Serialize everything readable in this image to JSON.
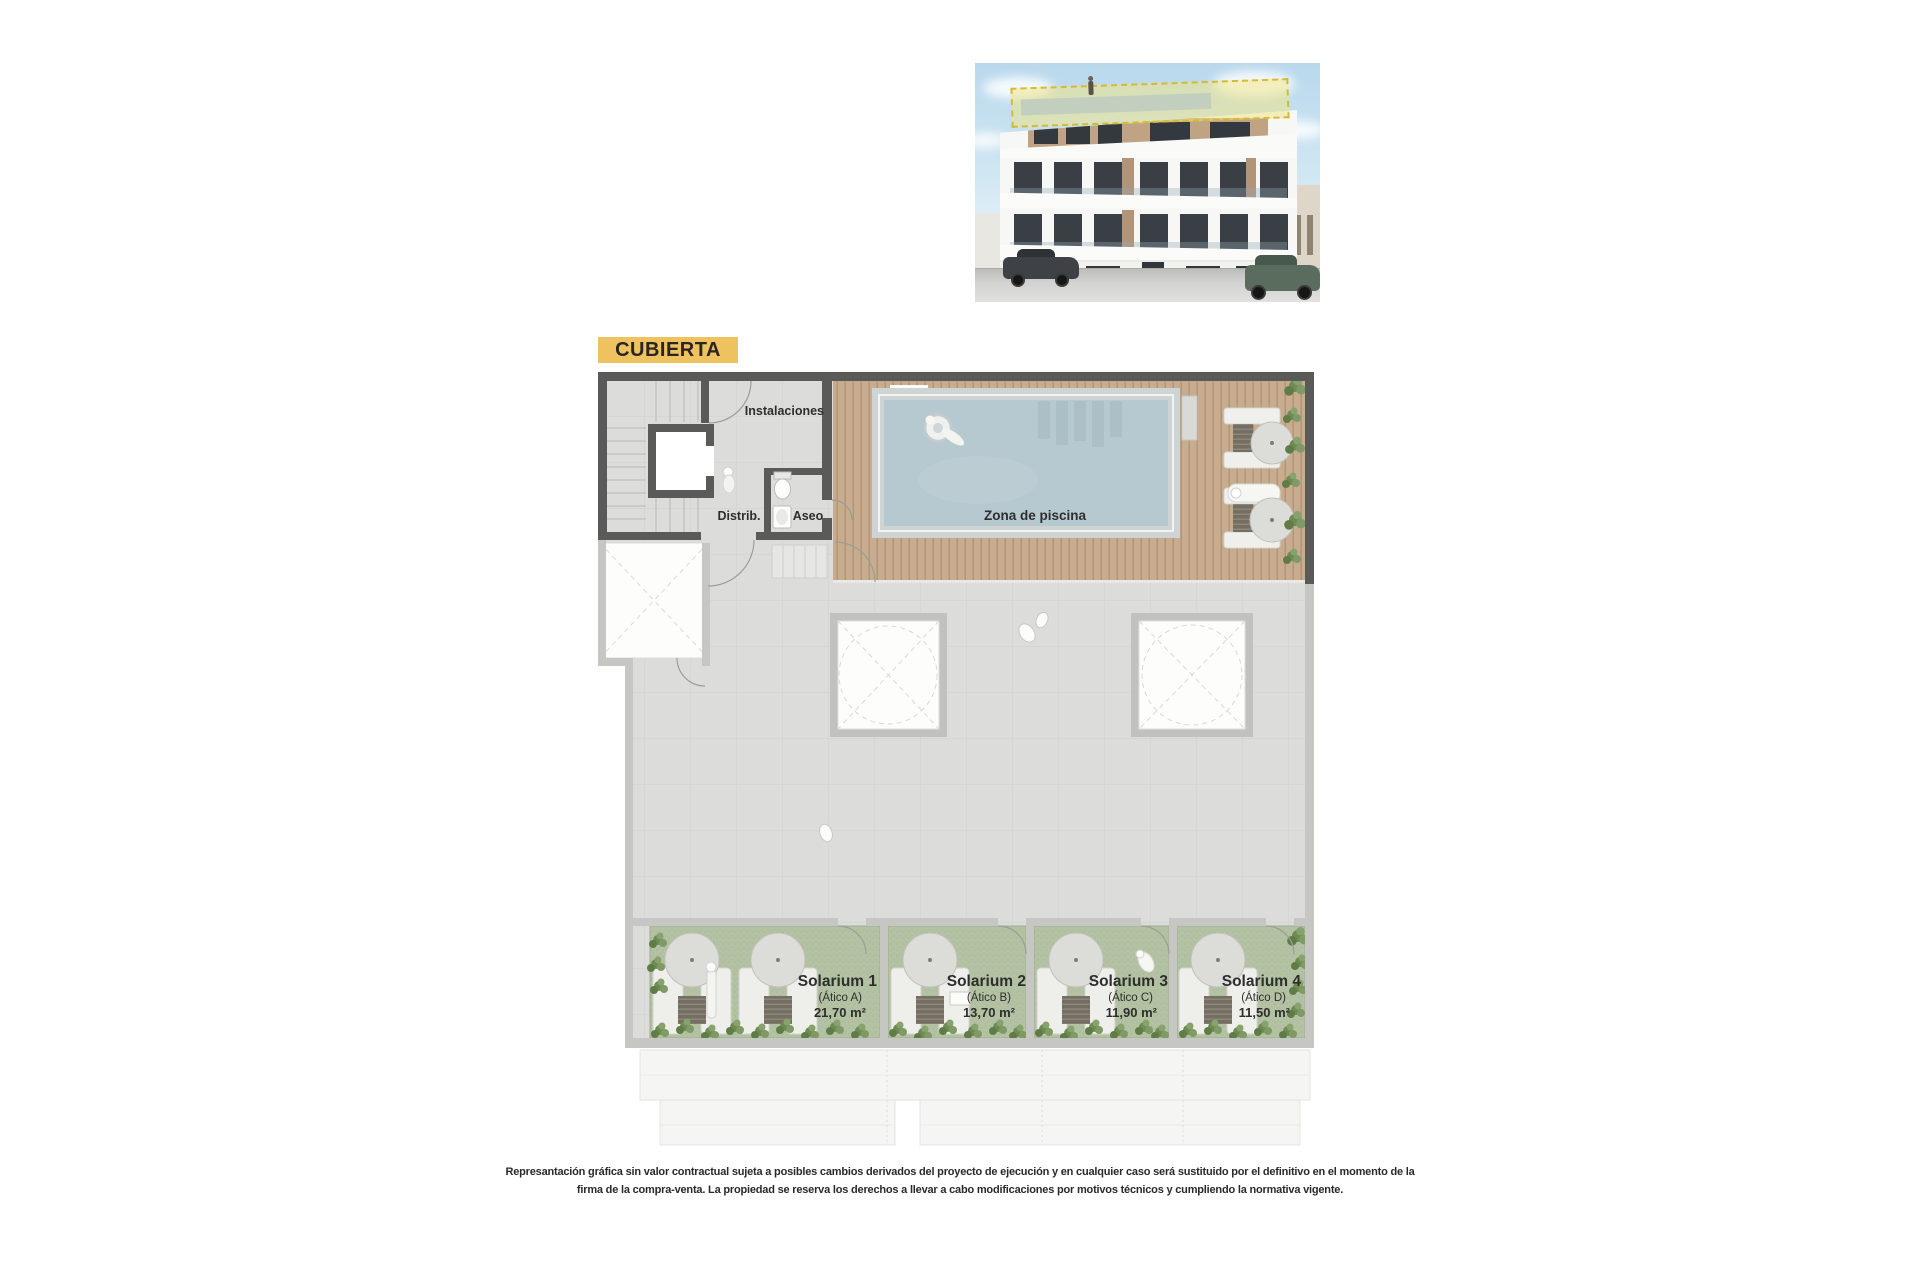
{
  "floor_label": {
    "text": "CUBIERTA"
  },
  "plan": {
    "rooms": {
      "instalaciones": "Instalaciones",
      "distribuidor": "Distrib.",
      "aseo": "Aseo",
      "pool_zone": "Zona de piscina"
    },
    "solariums": [
      {
        "name": "Solarium 1",
        "unit": "(Ático A)",
        "area": "21,70 m²"
      },
      {
        "name": "Solarium 2",
        "unit": "(Ático B)",
        "area": "13,70 m²"
      },
      {
        "name": "Solarium 3",
        "unit": "(Ático C)",
        "area": "11,90 m²"
      },
      {
        "name": "Solarium 4",
        "unit": "(Ático D)",
        "area": "11,50 m²"
      }
    ]
  },
  "colors": {
    "floor_label_bg": "#eec35f",
    "wall_dark": "#5a5a59",
    "wall_light": "#c6c6c3",
    "terrace_tile": "#dcdcda",
    "wood_deck": "#c7ac8e",
    "pool_water": "#b7c9d0",
    "solarium_turf": "#b3c2a3",
    "plant_green": "#6e8b53",
    "roof_highlight": "#e8d059"
  },
  "disclaimer": {
    "line1": "Represantación gráfica sin valor contractual sujeta a posibles cambios derivados del proyecto de ejecución y en cualquier caso será sustituido por el definitivo en el momento de la",
    "line2": "firma de la compra-venta. La propiedad se reserva los derechos a llevar a cabo modificaciones por motivos técnicos y cumpliendo la normativa vigente."
  }
}
